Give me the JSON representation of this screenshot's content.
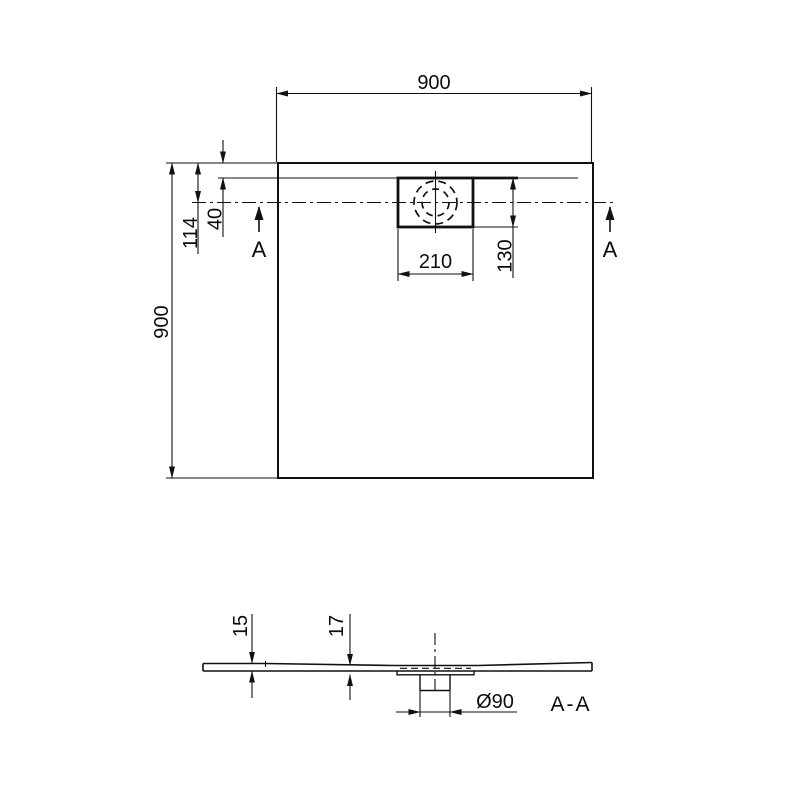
{
  "top_view": {
    "width_label": "900",
    "height_label": "900",
    "edge_to_centerline_label": "114",
    "edge_to_inner_label": "40",
    "drain_width_label": "210",
    "drain_depth_label": "130",
    "section_marker_left": "A",
    "section_marker_right": "A"
  },
  "section_view": {
    "edge_thickness_label": "15",
    "inner_thickness_label": "17",
    "drain_diameter_label": "Ø90",
    "title_label": "A-A"
  },
  "colors": {
    "line": "#111111",
    "background": "#ffffff"
  }
}
